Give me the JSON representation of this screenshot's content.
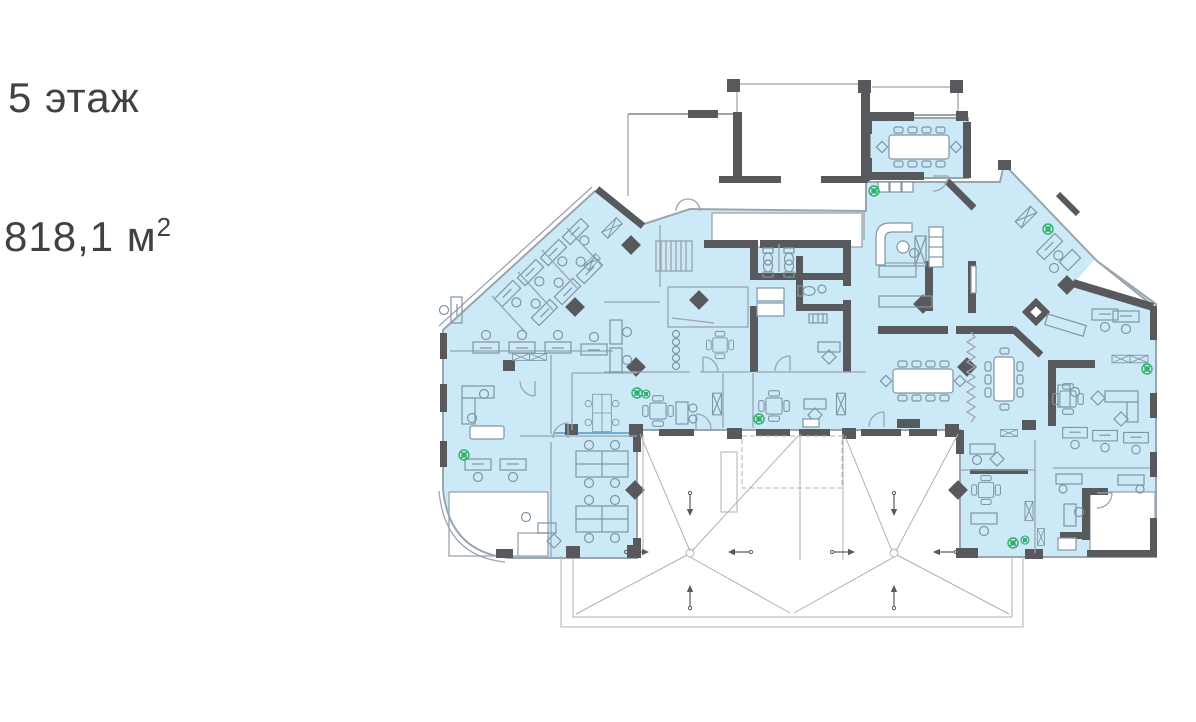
{
  "labels": {
    "floor_title": "5 этаж",
    "area_value": "818,1 м",
    "area_superscript": "2"
  },
  "floor_plan": {
    "floor_number": "5",
    "area_sqm": "818,1",
    "area_unit": "м²"
  },
  "colors": {
    "room_fill": "#cbe9f7",
    "wall": "#58595c",
    "thin": "#9aa5ae",
    "furn": "#7f95a6",
    "plant": "#2fb069",
    "roof": "#aeb2b5",
    "glass": "#66a3d2",
    "text": "#3f4144",
    "paper": "#ffffff"
  }
}
